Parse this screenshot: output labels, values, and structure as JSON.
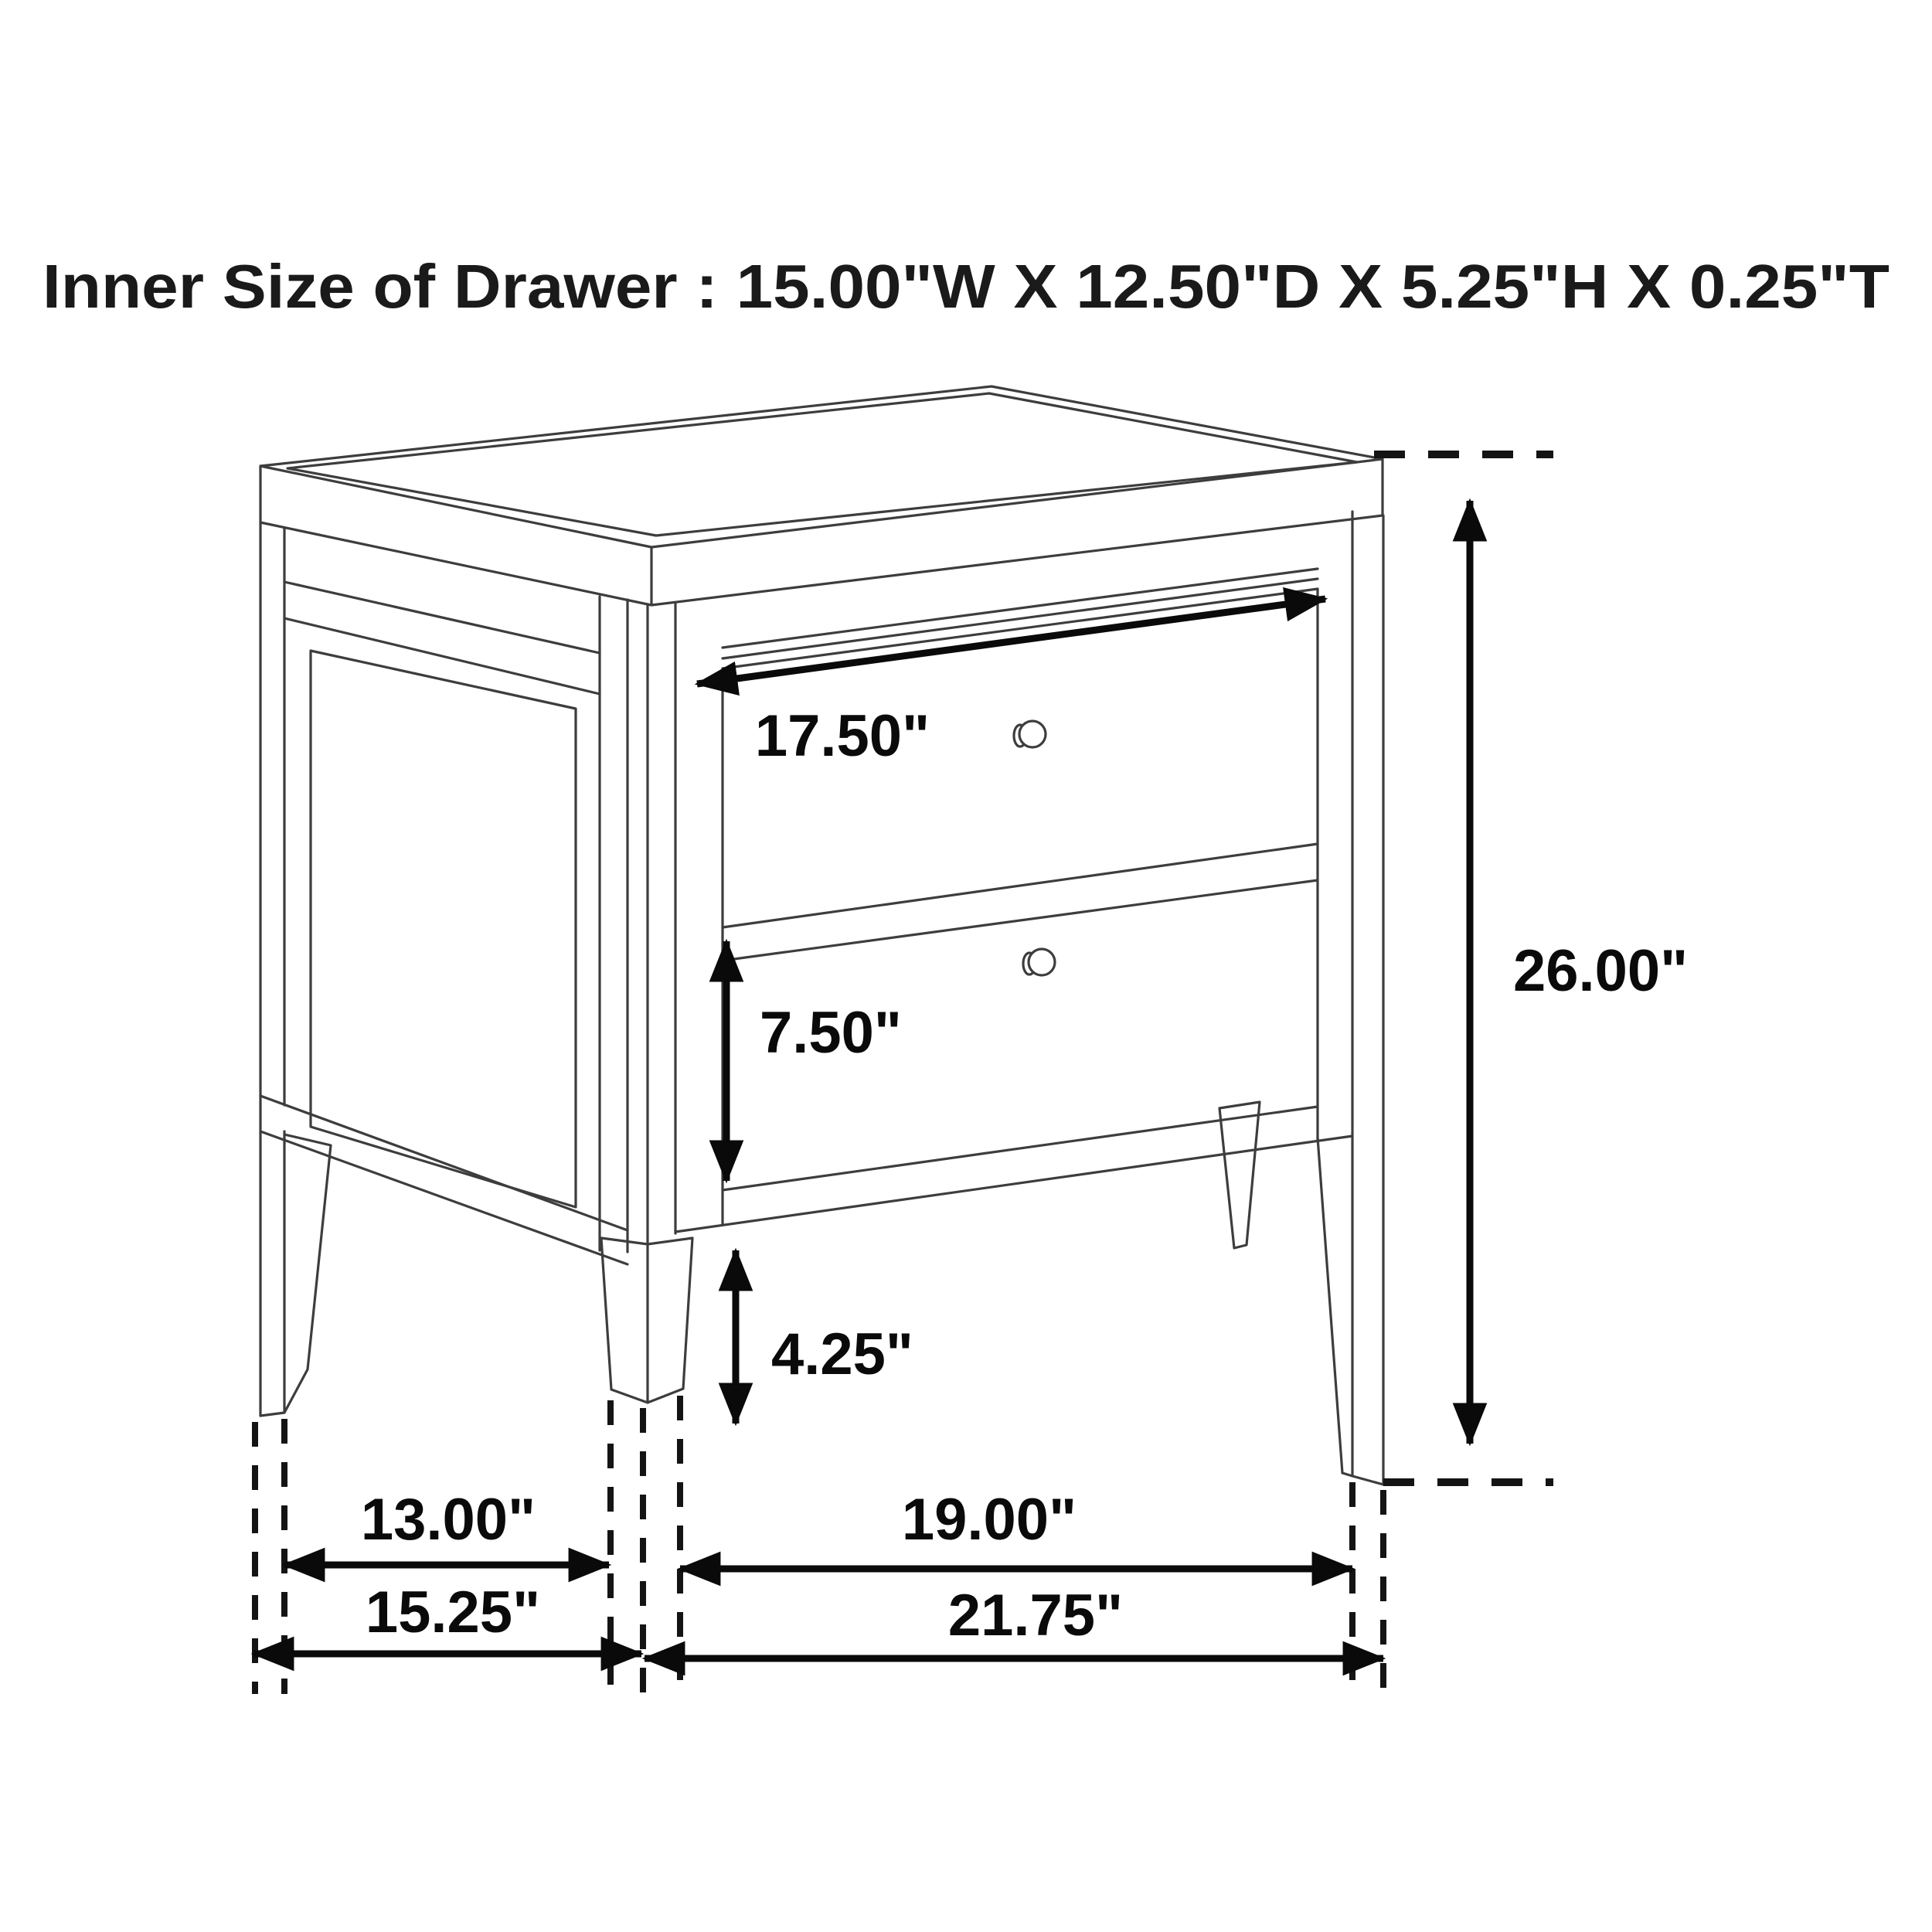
{
  "title": "Inner Size of Drawer : 15.00\"W X 12.50\"D X 5.25\"H X 0.25\"T",
  "subject": "two-drawer nightstand dimension line drawing",
  "unit": "inches",
  "labels": {
    "drawer_inner_width": "17.50\"",
    "overall_height": "26.00\"",
    "drawer_front_height": "7.50\"",
    "floor_clearance": "4.25\"",
    "side_leg_spacing_inner": "13.00\"",
    "front_leg_spacing_inner": "19.00\"",
    "overall_depth": "15.25\"",
    "overall_width": "21.75\""
  },
  "colors": {
    "background": "#ffffff",
    "line_art": "#3d3d3d",
    "dimension_ink": "#0a0a0a"
  }
}
